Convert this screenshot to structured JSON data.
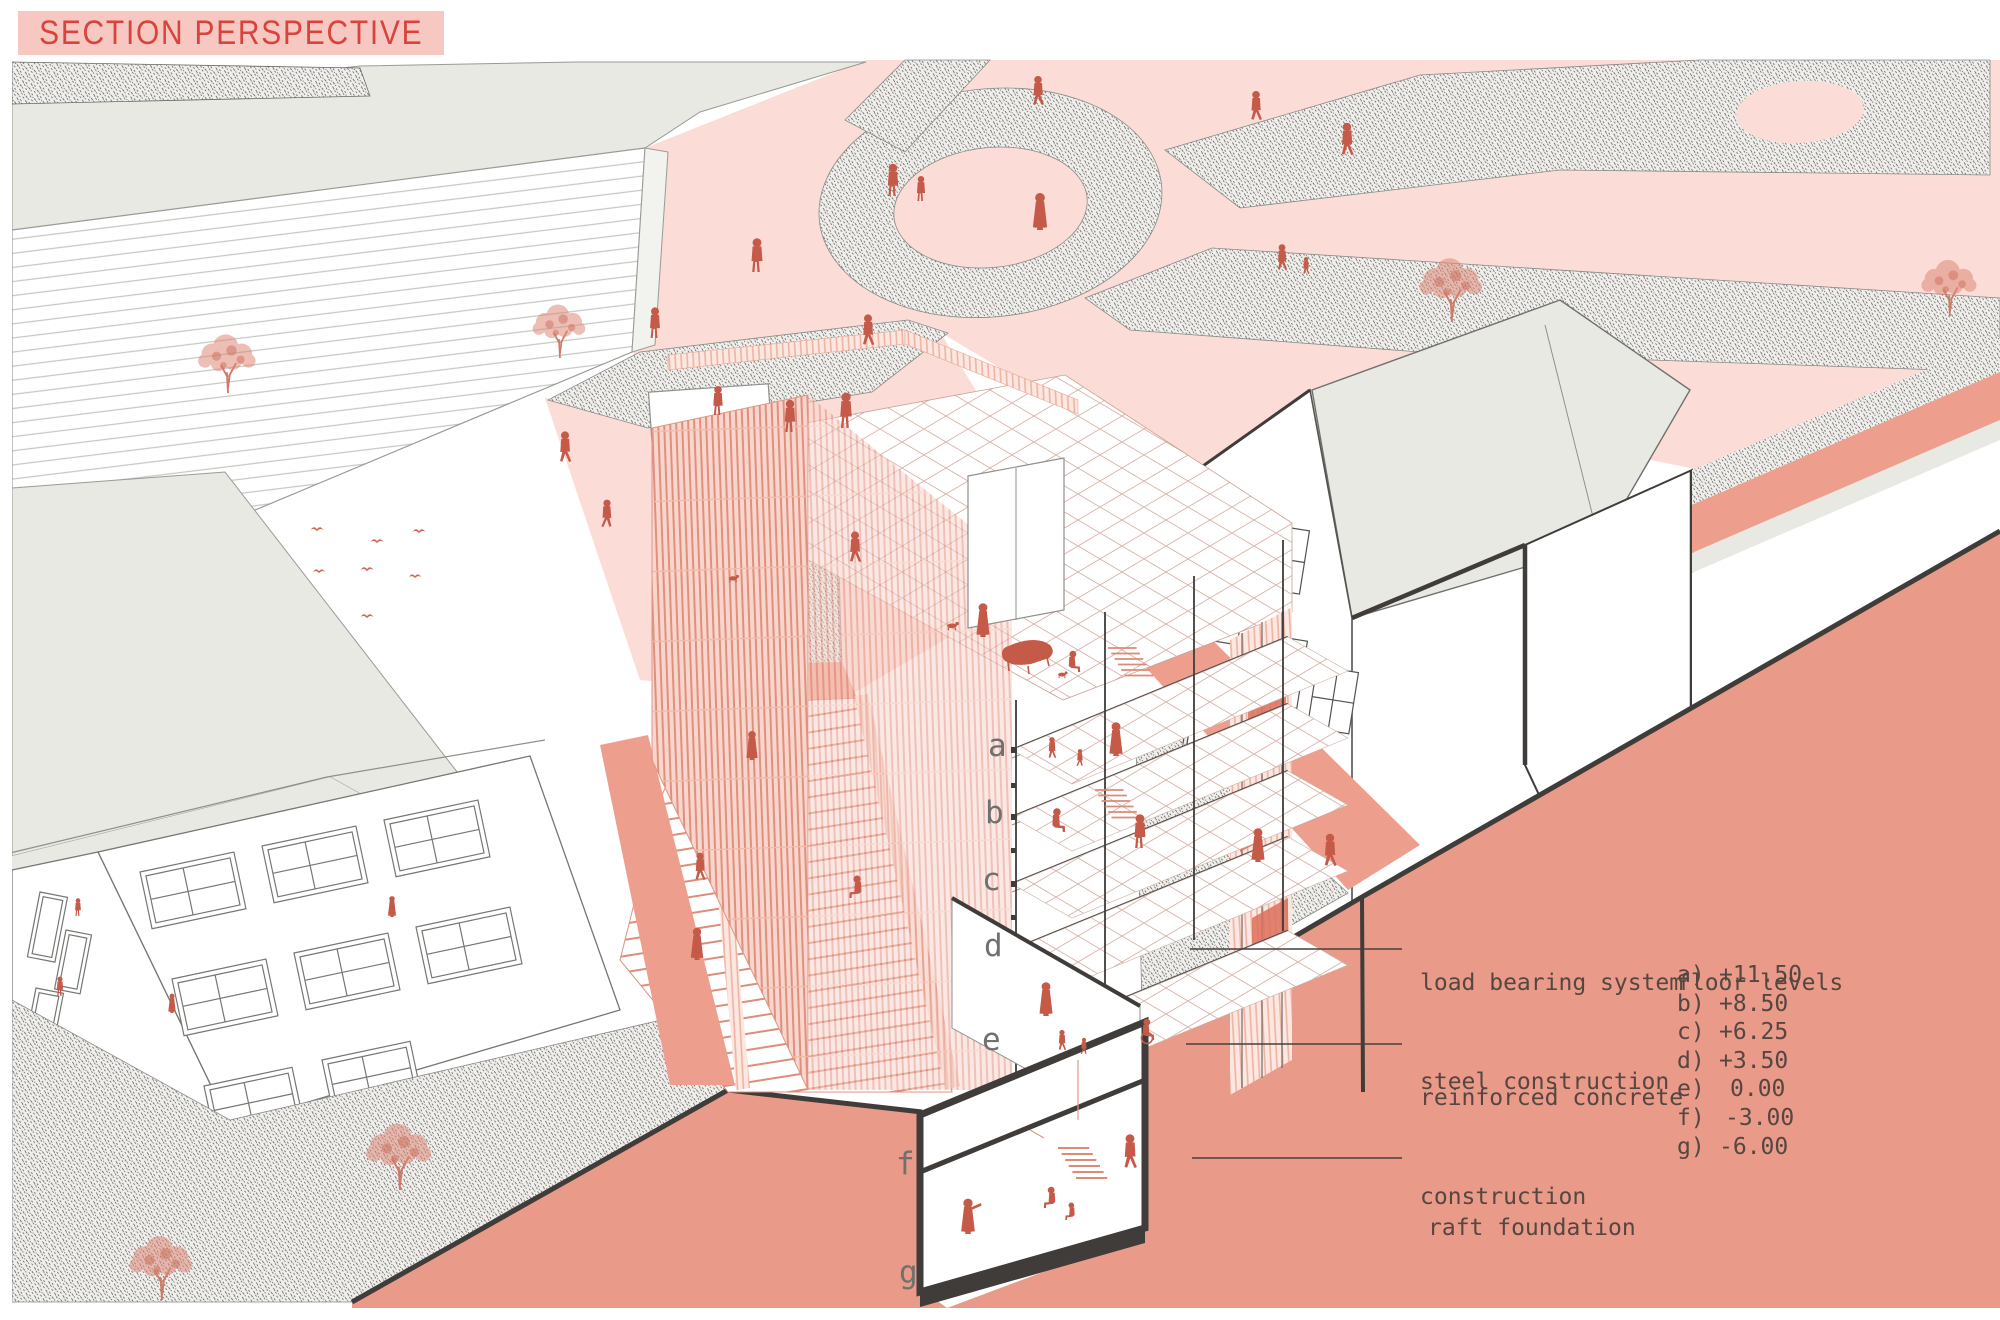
{
  "title": "SECTION PERSPECTIVE",
  "annotations": {
    "load_bearing": {
      "line1": "load bearing system",
      "line2": "steel construction"
    },
    "concrete": {
      "line1": "reinforced concrete",
      "line2": "construction"
    },
    "raft": "raft foundation",
    "floor_levels_title": "floor levels",
    "levels": [
      {
        "label": "a)",
        "value": "+11.50"
      },
      {
        "label": "b)",
        "value": "+8.50"
      },
      {
        "label": "c)",
        "value": "+6.25"
      },
      {
        "label": "d)",
        "value": "+3.50"
      },
      {
        "label": "e)",
        "value": "0.00"
      },
      {
        "label": "f)",
        "value": "-3.00"
      },
      {
        "label": "g)",
        "value": "-6.00"
      }
    ]
  },
  "section_letters": [
    "a",
    "b",
    "c",
    "d",
    "e",
    "f",
    "g"
  ],
  "colors": {
    "accent_red": "#d8443c",
    "title_background": "#f7c7c2",
    "plaza_pink": "#fbdcd6",
    "earth_terracotta": "#ea9a89",
    "people_terracotta": "#c45a47",
    "roof_gray": "#e9e9e3",
    "annotation_ink": "#554641"
  }
}
